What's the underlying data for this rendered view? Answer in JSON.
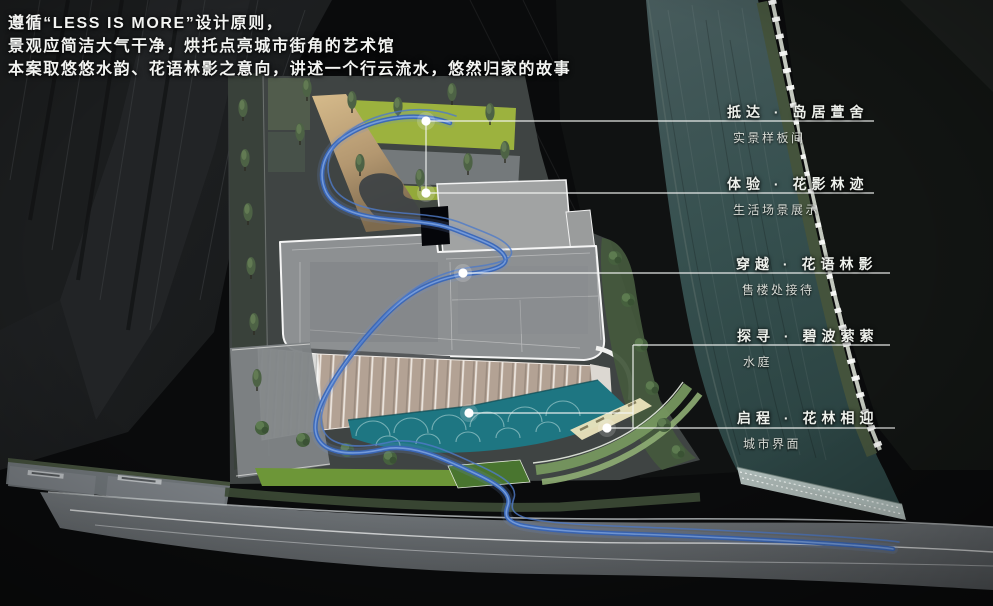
{
  "canvas": {
    "width": 993,
    "height": 606
  },
  "heading": {
    "lines": [
      "遵循“LESS IS MORE”设计原则，",
      "景观应简洁大气干净，烘托点亮城市街角的艺术馆",
      "本案取悠悠水韵、花语林影之意向，讲述一个行云流水，悠然归家的故事"
    ]
  },
  "annotations": {
    "items": [
      {
        "title": "抵达 · 岛居萱舍",
        "subtitle": "实景样板间"
      },
      {
        "title": "体验 · 花影林迹",
        "subtitle": "生活场景展示"
      },
      {
        "title": "穿越 · 花语林影",
        "subtitle": "售楼处接待"
      },
      {
        "title": "探寻 · 碧波萦萦",
        "subtitle": "水庭"
      },
      {
        "title": "启程 · 花林相迎",
        "subtitle": "城市界面"
      }
    ]
  },
  "icons": {
    "journey_node": "white-dot",
    "tree": "tree-canopy"
  },
  "colors": {
    "background": "#0a0b0c",
    "journey_blue": "#3a67b8",
    "river_water": "#3a5152",
    "pool_teal": "#1e7682",
    "lawn_green": "#9ab23f",
    "roof_gray": "#8d9092",
    "facade_beige": "#b4a295",
    "road_gray": "#64696c",
    "leader_white": "#f5f7f5"
  }
}
